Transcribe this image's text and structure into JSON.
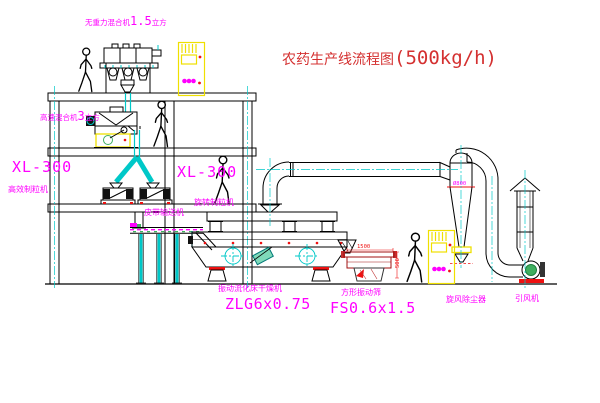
{
  "title": {
    "text": "农药生产线流程图",
    "capacity": "(500kg/h)"
  },
  "equipment_labels": {
    "gravity_mixer": {
      "pre": "无重力混合机",
      "num": "1.5",
      "post": "立方"
    },
    "high_speed_mixer": {
      "pre": "高速混合机",
      "num": "3",
      "post": "立方"
    },
    "granulator_left_model": "XL-300",
    "granulator_left_name": "高效制粒机",
    "granulator_right_model": "XL-300",
    "granulator_right_name": "旋转制粒机",
    "belt_conveyor": "皮带输送机",
    "fluid_bed_dryer": "振动流化床干燥机",
    "fluid_bed_dryer_model": "ZLG6x0.75",
    "vibrating_screen": "方形振动筛",
    "vibrating_screen_model": "FS0.6x1.5",
    "cyclone": "旋风除尘器",
    "fan": "引风机"
  },
  "dimensions": {
    "screen_length": "1500",
    "screen_height": "500",
    "cyclone_dia": "Ø800"
  },
  "colors": {
    "line_black": "#000000",
    "line_cyan": "#00C8C8",
    "label_magenta": "#FF00FF",
    "title_red": "#D43030",
    "cabinet_yellow": "#EFE000",
    "accent_red": "#EE1111",
    "motor_green": "#3FAF5F"
  }
}
